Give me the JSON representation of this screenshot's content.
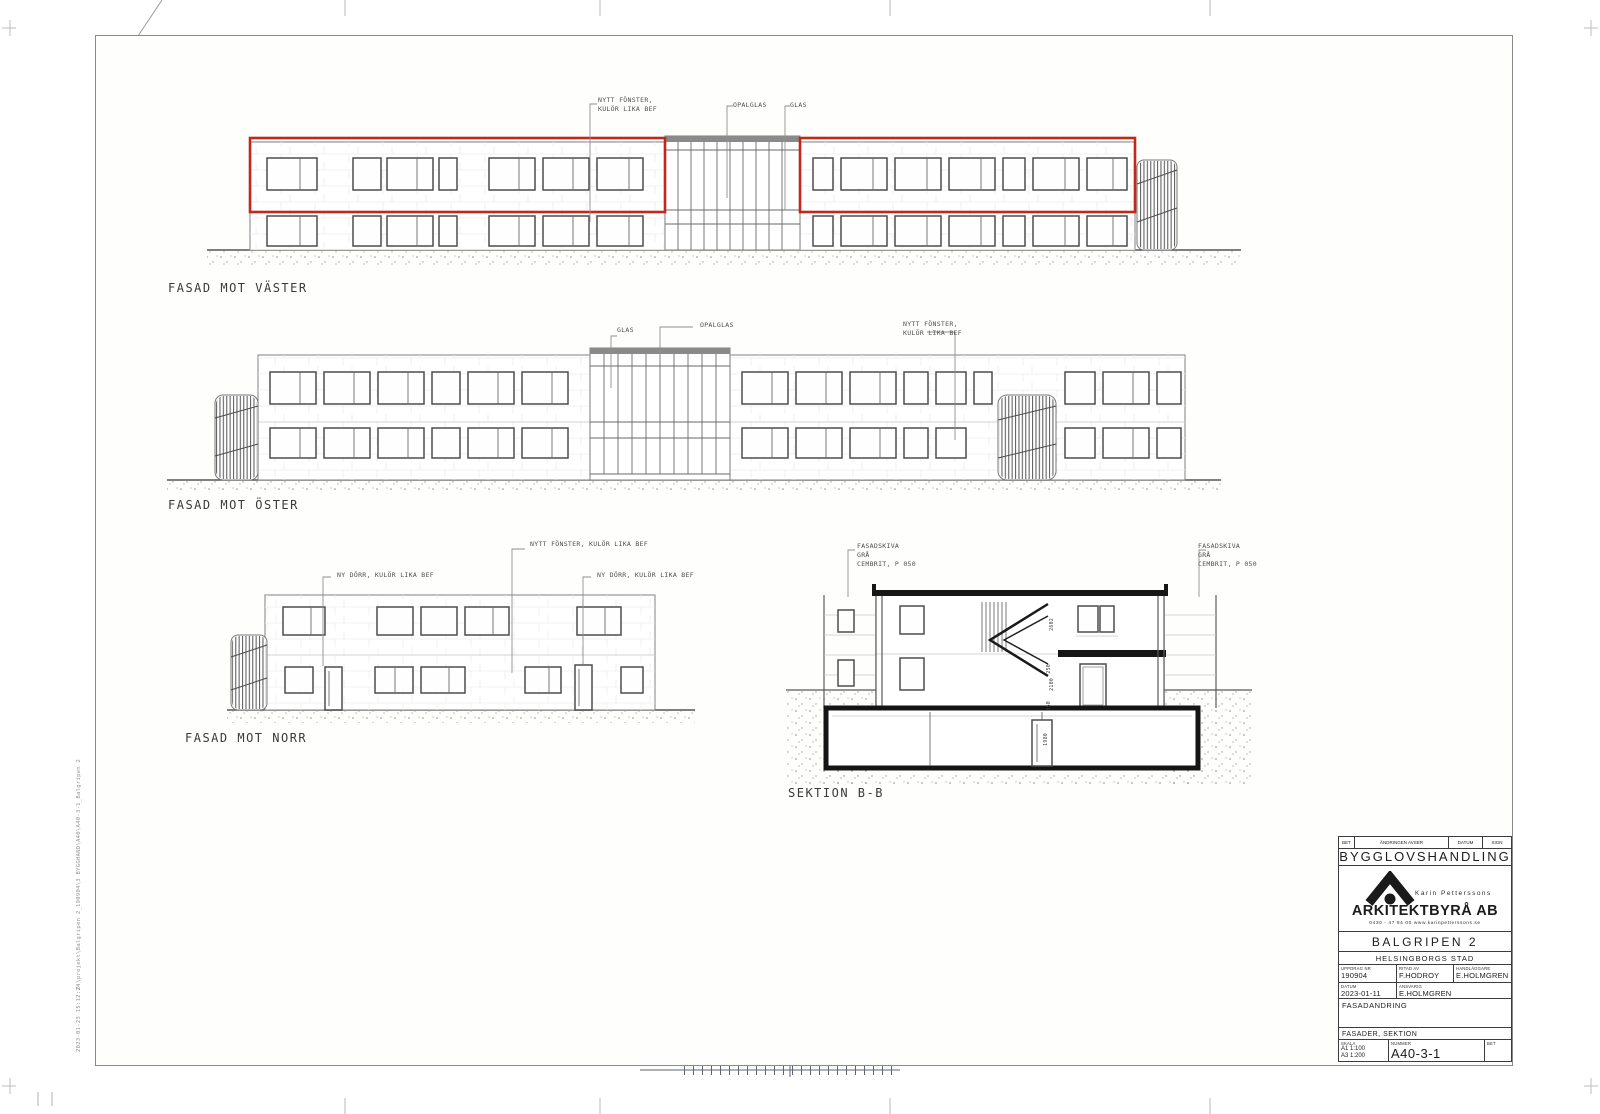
{
  "drawings": {
    "west": {
      "label": "FASAD MOT VÄSTER",
      "ann_fonster": [
        "NYTT FÖNSTER,",
        "KULÖR LIKA BEF"
      ],
      "ann_opalglas": "OPALGLAS",
      "ann_glas": "GLAS"
    },
    "east": {
      "label": "FASAD MOT ÖSTER",
      "ann_glas": "GLAS",
      "ann_opalglas": "OPALGLAS",
      "ann_fonster": [
        "NYTT FÖNSTER,",
        "KULÖR LIKA BEF"
      ]
    },
    "north": {
      "label": "FASAD MOT NORR",
      "ann_fonster": "NYTT FÖNSTER, KULÖR LIKA BEF",
      "ann_dorr_left": "NY DÖRR, KULÖR LIKA BEF",
      "ann_dorr_right": "NY DÖRR, KULÖR LIKA BEF"
    },
    "section": {
      "label": "SEKTION B-B",
      "ann_left": [
        "FASADSKIVA",
        "GRÅ",
        "CEMBRIT, P 050"
      ],
      "ann_right": [
        "FASADSKIVA",
        "GRÅ",
        "CEMBRIT, P 050"
      ],
      "dims": [
        "2602",
        "250",
        "2100",
        "350",
        "1980"
      ]
    }
  },
  "titleblock": {
    "header": {
      "bet": "BET",
      "andringen_avser": "ÄNDRINGEN AVSER",
      "datum": "DATUM",
      "sign": "SIGN"
    },
    "stamp": "BYGGLOVSHANDLING",
    "firm_owner": "Karin Petterssons",
    "firm_name": "ARKITEKTBYRÅ AB",
    "firm_contact": "0430 - 47 84 00     www.karinpetterssons.se",
    "project": "BALGRIPEN 2",
    "city": "HELSINGBORGS STAD",
    "uppdrag_label": "UPPDRAG NR",
    "uppdrag_nr": "190904",
    "ritad_label": "RITAD AV",
    "ritad_av": "F.HODROY",
    "handlaggare_label": "HANDLÄGGARE",
    "handlaggare": "E.HOLMGREN",
    "datum_label": "DATUM",
    "datum": "2023-01-11",
    "ansvarig_label": "ANSVARIG",
    "ansvarig": "E.HOLMGREN",
    "change_title": "FASADANDRING",
    "sheet_content": "FASADER, SEKTION",
    "skala_label": "SKALA",
    "skala_a1": "A1  1:100",
    "skala_a3": "A3  1:200",
    "nummer_label": "NUMMER",
    "nummer": "A40-3-1",
    "bet_label": "BET"
  },
  "margin": {
    "plot_path": "Z:\\projekt\\Balgripen 2_190904\\3 BYGGHAND\\A40\\A40-3-1_Balgripen 2",
    "plot_date": "2023-01-23 15:12:24"
  },
  "colors": {
    "highlight_red": "#c0281c",
    "line_gray": "#6b6b6b",
    "heavy_black": "#161616"
  }
}
